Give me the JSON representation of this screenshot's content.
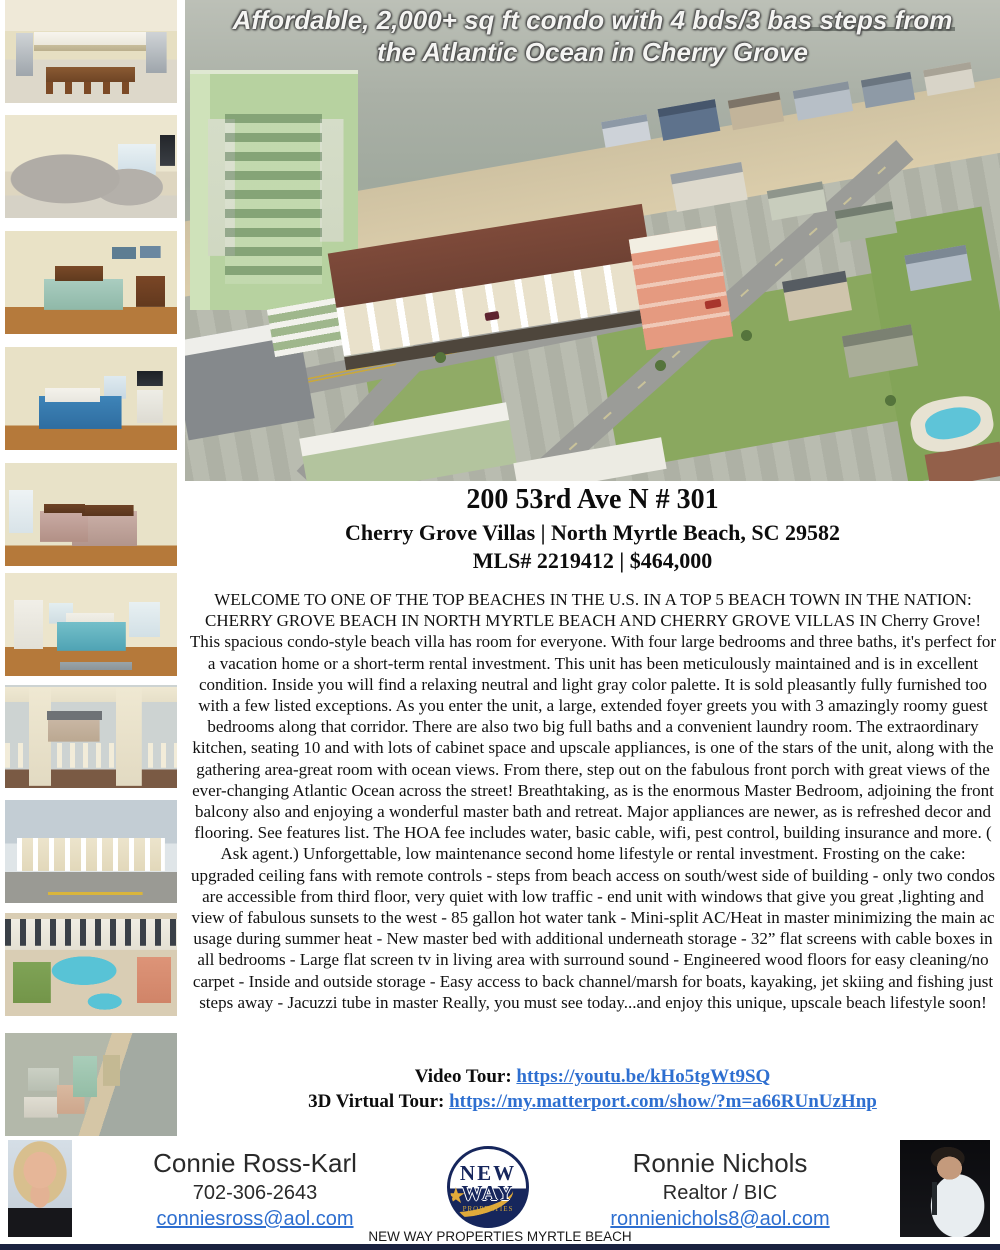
{
  "header": {
    "headline": "Affordable, 2,000+ sq ft condo with 4 bds/3 bas steps from the Atlantic Ocean in Cherry Grove"
  },
  "listing": {
    "title": "200 53rd Ave N # 301",
    "subtitle": "Cherry Grove Villas | North Myrtle Beach, SC 29582",
    "mls_line": "MLS# 2219412 | $464,000",
    "description": "WELCOME TO ONE OF THE TOP BEACHES IN THE U.S. IN A TOP 5 BEACH TOWN IN THE NATION: CHERRY GROVE BEACH IN NORTH MYRTLE BEACH AND CHERRY GROVE VILLAS IN Cherry Grove! This spacious condo-style beach villa has room for everyone. With four large bedrooms and three baths, it's perfect for a vacation home or a short-term rental investment. This unit has been meticulously maintained and is in excellent condition. Inside you will find a relaxing neutral and light gray color palette. It is sold pleasantly fully furnished too with a few listed exceptions. As you enter the unit, a large, extended foyer greets you with 3 amazingly roomy guest bedrooms along that corridor. There are also two big full baths and a convenient laundry room. The extraordinary kitchen, seating 10 and with lots of cabinet space and upscale appliances, is one of the stars of the unit, along with the gathering area-great room with ocean views. From there, step out on the fabulous front porch with great views of the ever-changing Atlantic Ocean across the street! Breathtaking, as is the enormous Master Bedroom, adjoining the front balcony also and enjoying a wonderful master bath and retreat. Major appliances are newer, as is refreshed decor and flooring. See features list. The HOA fee includes water, basic cable, wifi, pest control, building insurance and more. ( Ask agent.) Unforgettable, low maintenance second home lifestyle or rental investment. Frosting on the cake: upgraded ceiling fans with remote controls - steps from beach access on south/west side of building - only two condos are accessible from third floor, very quiet with low traffic - end unit with windows that give you great ,lighting and view of fabulous sunsets to the west - 85 gallon hot water tank - Mini-split AC/Heat in master minimizing the main ac usage during summer heat - New master bed with additional underneath storage - 32” flat screens with cable boxes in all bedrooms - Large flat screen tv in living area with surround sound - Engineered wood floors for easy cleaning/no carpet - Inside and outside storage - Easy access to back channel/marsh for boats, kayaking, jet skiing and fishing just steps away - Jacuzzi tube in master Really, you must see today...and enjoy this unique, upscale beach lifestyle soon!"
  },
  "tours": {
    "video_label": "Video Tour:",
    "video_url": "https://youtu.be/kHo5tgWt9SQ",
    "virtual_label": "3D Virtual Tour:",
    "virtual_url": "https://my.matterport.com/show/?m=a66RUnUzHnp"
  },
  "footer": {
    "agent_left": {
      "name": "Connie Ross-Karl",
      "phone": "702-306-2643",
      "email": "conniesross@aol.com"
    },
    "agent_right": {
      "name": "Ronnie Nichols",
      "role": "Realtor / BIC",
      "email": "ronnienichols8@aol.com"
    },
    "brokerage": {
      "logo_top": "NEW",
      "logo_bottom": "WAY",
      "logo_sub": "PROPERTIES",
      "logo_star": "★",
      "caption": "NEW WAY PROPERTIES MYRTLE BEACH"
    }
  },
  "photos": {
    "sidebar": [
      "kitchen-dining",
      "living-room",
      "guest-bedroom-1",
      "guest-bedroom-2",
      "guest-bedroom-3",
      "master-bedroom",
      "front-porch",
      "building-exterior",
      "courtyard-pool-aerial",
      "beach-town-aerial"
    ],
    "main": "aerial-view-cherry-grove-beach"
  },
  "colors": {
    "link_blue": "#2e6fd0",
    "footer_bar": "#1a2240"
  }
}
